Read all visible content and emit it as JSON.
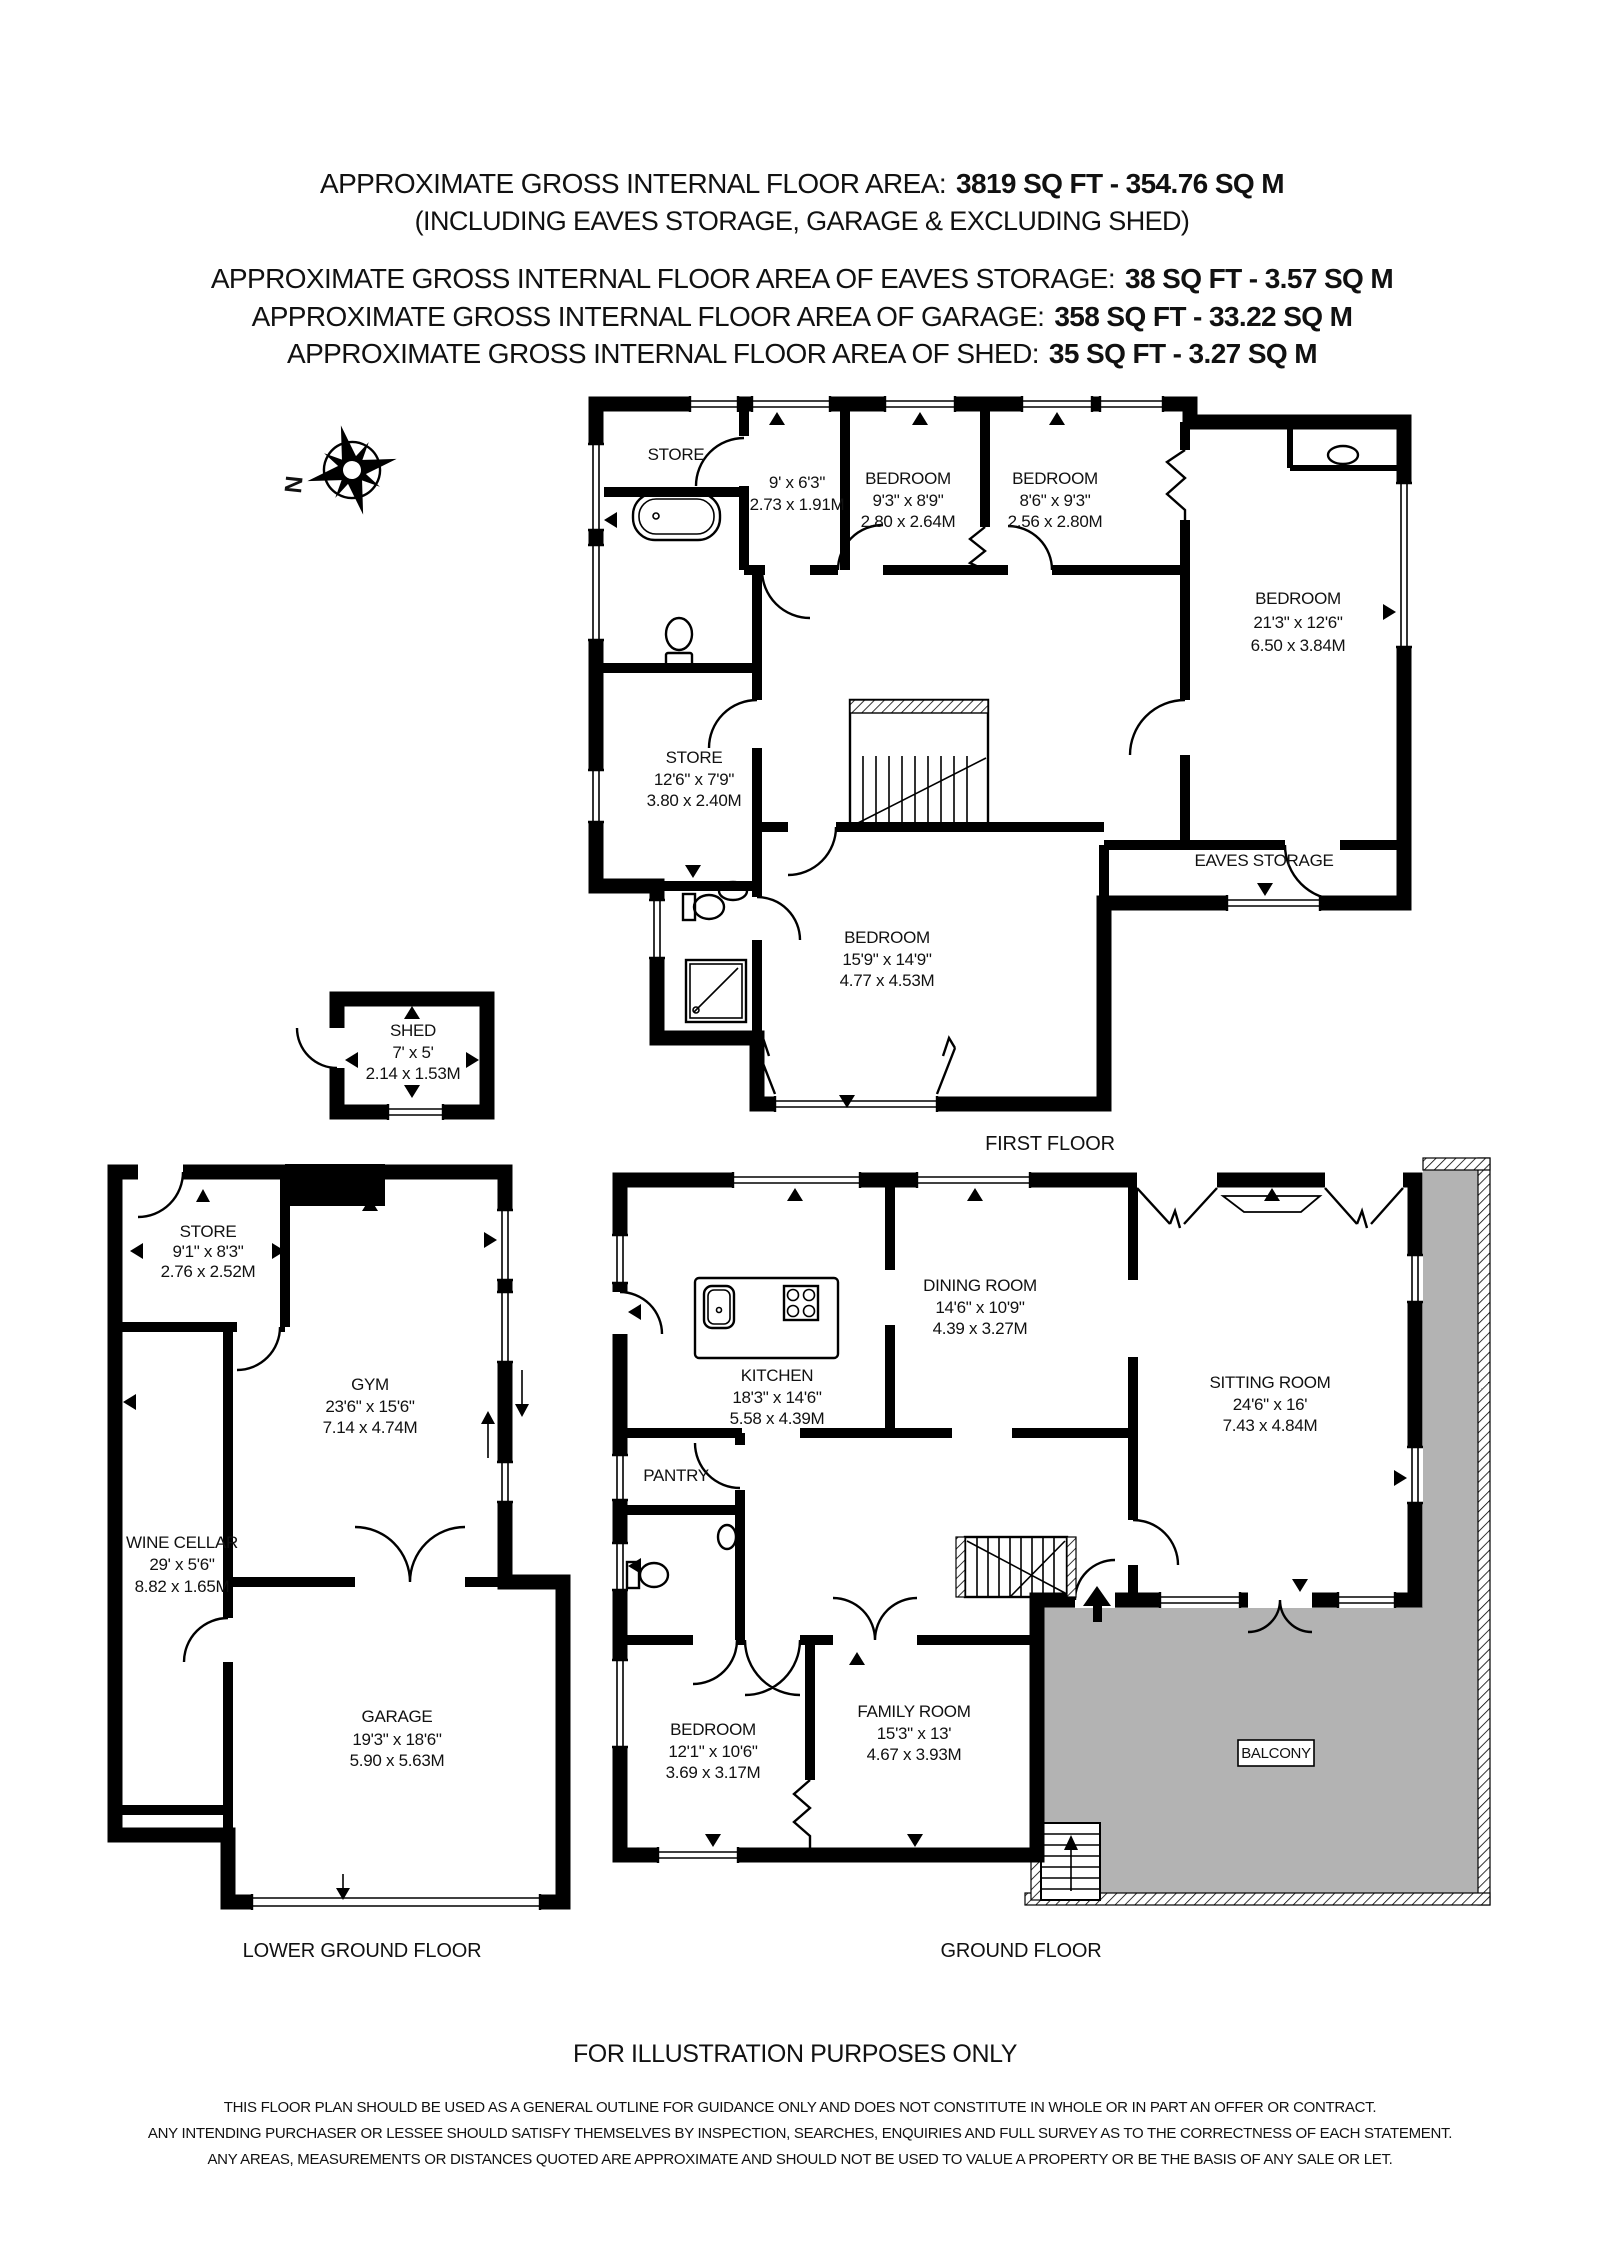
{
  "header": {
    "lines": [
      {
        "label": "APPROXIMATE GROSS INTERNAL FLOOR AREA:",
        "value": "3819 SQ FT - 354.76 SQ M"
      },
      {
        "label": "(INCLUDING EAVES STORAGE, GARAGE & EXCLUDING SHED)",
        "value": ""
      },
      {
        "label": "APPROXIMATE GROSS INTERNAL FLOOR AREA OF EAVES STORAGE:",
        "value": "38 SQ FT - 3.57 SQ M"
      },
      {
        "label": "APPROXIMATE GROSS INTERNAL FLOOR AREA OF GARAGE:",
        "value": "358 SQ FT - 33.22 SQ M"
      },
      {
        "label": "APPROXIMATE GROSS INTERNAL FLOOR AREA OF SHED:",
        "value": "35 SQ FT - 3.27 SQ M"
      }
    ]
  },
  "compass": {
    "north": "N"
  },
  "floors": {
    "first": {
      "label": "FIRST FLOOR",
      "rooms": {
        "store_top": {
          "name": "STORE"
        },
        "landing": {
          "ft": "9' x 6'3\"",
          "m": "2.73 x 1.91M"
        },
        "bedroom_a": {
          "name": "BEDROOM",
          "ft": "9'3\" x 8'9\"",
          "m": "2.80 x 2.64M"
        },
        "bedroom_b": {
          "name": "BEDROOM",
          "ft": "8'6\" x 9'3\"",
          "m": "2.56 x 2.80M"
        },
        "bedroom_c": {
          "name": "BEDROOM",
          "ft": "21'3\" x 12'6\"",
          "m": "6.50 x 3.84M"
        },
        "store_mid": {
          "name": "STORE",
          "ft": "12'6\" x 7'9\"",
          "m": "3.80 x 2.40M"
        },
        "bedroom_d": {
          "name": "BEDROOM",
          "ft": "15'9\" x 14'9\"",
          "m": "4.77 x 4.53M"
        },
        "eaves": {
          "name": "EAVES STORAGE"
        }
      }
    },
    "shed": {
      "name": "SHED",
      "ft": "7' x 5'",
      "m": "2.14 x 1.53M"
    },
    "ground": {
      "label": "GROUND FLOOR",
      "rooms": {
        "kitchen": {
          "name": "KITCHEN",
          "ft": "18'3\" x 14'6\"",
          "m": "5.58 x 4.39M"
        },
        "dining": {
          "name": "DINING ROOM",
          "ft": "14'6\" x 10'9\"",
          "m": "4.39 x 3.27M"
        },
        "sitting": {
          "name": "SITTING ROOM",
          "ft": "24'6\" x 16'",
          "m": "7.43 x 4.84M"
        },
        "pantry": {
          "name": "PANTRY"
        },
        "bedroom": {
          "name": "BEDROOM",
          "ft": "12'1\" x 10'6\"",
          "m": "3.69 x 3.17M"
        },
        "family": {
          "name": "FAMILY ROOM",
          "ft": "15'3\" x 13'",
          "m": "4.67 x 3.93M"
        },
        "balcony": {
          "name": "BALCONY"
        }
      }
    },
    "lower": {
      "label": "LOWER GROUND FLOOR",
      "rooms": {
        "store": {
          "name": "STORE",
          "ft": "9'1\" x 8'3\"",
          "m": "2.76 x 2.52M"
        },
        "gym": {
          "name": "GYM",
          "ft": "23'6\" x 15'6\"",
          "m": "7.14 x 4.74M"
        },
        "wine": {
          "name": "WINE CELLAR",
          "ft": "29' x 5'6\"",
          "m": "8.82 x 1.65M"
        },
        "garage": {
          "name": "GARAGE",
          "ft": "19'3\" x 18'6\"",
          "m": "5.90 x 5.63M"
        }
      }
    }
  },
  "footer": {
    "title": "FOR ILLUSTRATION PURPOSES ONLY",
    "disclaimer": [
      "THIS FLOOR PLAN SHOULD BE USED AS A GENERAL OUTLINE FOR GUIDANCE ONLY AND DOES NOT CONSTITUTE IN WHOLE OR IN PART AN OFFER OR CONTRACT.",
      "ANY INTENDING PURCHASER OR LESSEE SHOULD SATISFY THEMSELVES BY INSPECTION, SEARCHES, ENQUIRIES AND FULL SURVEY AS TO THE CORRECTNESS OF EACH STATEMENT.",
      "ANY AREAS, MEASUREMENTS OR DISTANCES QUOTED ARE APPROXIMATE AND SHOULD NOT BE USED TO VALUE A PROPERTY OR BE THE BASIS OF ANY SALE OR LET."
    ]
  },
  "colors": {
    "wall": "#000000",
    "balcony_fill": "#b3b3b3"
  }
}
